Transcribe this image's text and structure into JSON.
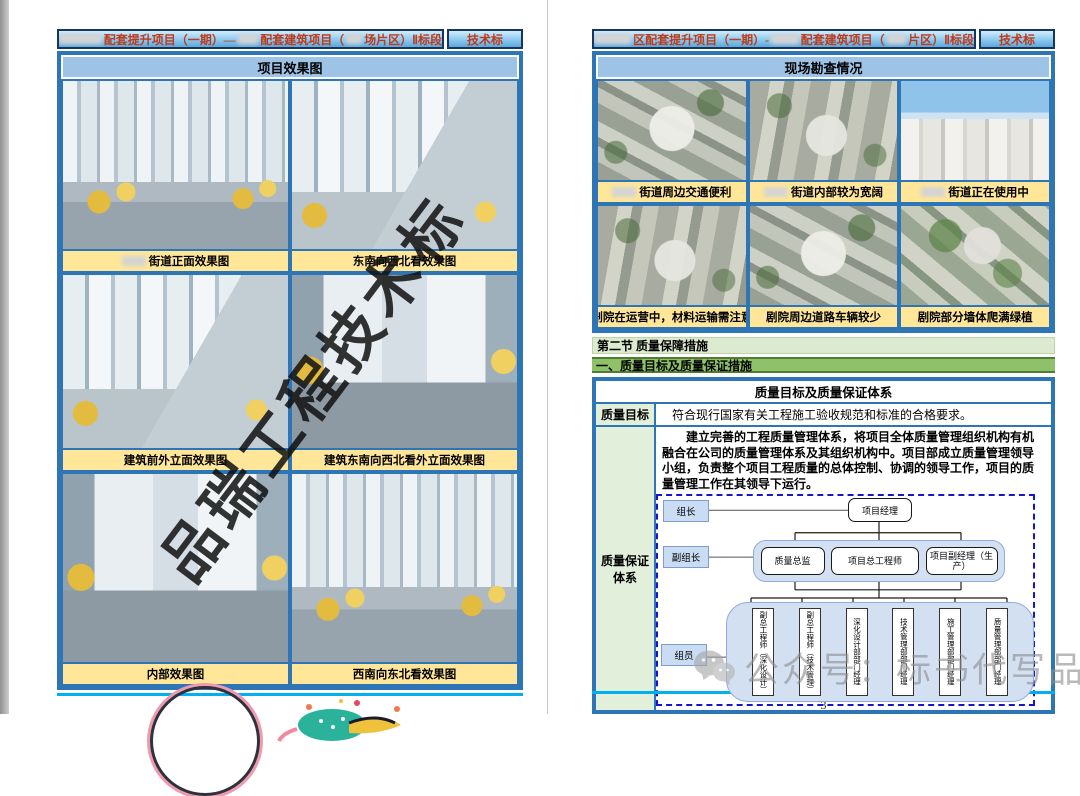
{
  "viewer": {
    "page_number": "3"
  },
  "header_left": {
    "segments": [
      {
        "r": 108
      },
      {
        "t": "配套提升项目（一期）—"
      },
      {
        "r": 52
      },
      {
        "t": "配套建筑项目（"
      },
      {
        "r": 40
      },
      {
        "t": "场片区）Ⅱ标段"
      }
    ],
    "tag": "技术标"
  },
  "header_right": {
    "segments": [
      {
        "r": 84
      },
      {
        "t": "区配套提升项目（一期）-"
      },
      {
        "r": 62
      },
      {
        "t": "配套建筑项目（"
      },
      {
        "r": 44
      },
      {
        "t": "片区）Ⅱ标段"
      }
    ],
    "tag": "技术标"
  },
  "left_page": {
    "section_title": "项目效果图",
    "diagonal_watermark": "品瑞工程技术标",
    "images": [
      {
        "caption": "街道正面效果图",
        "caption_redacted_prefix": true,
        "image_kind": "building-rendering"
      },
      {
        "caption": "东南向西北看效果图",
        "caption_redacted_prefix": false,
        "image_kind": "building-rendering"
      },
      {
        "caption": "建筑前外立面效果图",
        "caption_redacted_prefix": false,
        "image_kind": "building-rendering"
      },
      {
        "caption": "建筑东南向西北看外立面效果图",
        "caption_redacted_prefix": false,
        "image_kind": "building-rendering"
      },
      {
        "caption": "内部效果图",
        "caption_redacted_prefix": false,
        "image_kind": "building-rendering"
      },
      {
        "caption": "西南向东北看效果图",
        "caption_redacted_prefix": false,
        "image_kind": "building-rendering"
      }
    ]
  },
  "right_page": {
    "section_title": "现场勘查情况",
    "photos": [
      {
        "caption": "街道周边交通便利",
        "caption_redacted_prefix": true,
        "image_kind": "aerial-photo"
      },
      {
        "caption": "街道内部较为宽阔",
        "caption_redacted_prefix": true,
        "image_kind": "aerial-photo"
      },
      {
        "caption": "街道正在使用中",
        "caption_redacted_prefix": true,
        "image_kind": "street-photo"
      },
      {
        "caption": "剧院在运营中，材料运输需注意",
        "caption_redacted_prefix": false,
        "image_kind": "aerial-photo"
      },
      {
        "caption": "剧院周边道路车辆较少",
        "caption_redacted_prefix": false,
        "image_kind": "aerial-photo"
      },
      {
        "caption": "剧院部分墙体爬满绿植",
        "caption_redacted_prefix": false,
        "image_kind": "aerial-photo"
      }
    ],
    "section2_heading": "第二节 质量保障措施",
    "sub_heading": "一、质量目标及质量保证措施",
    "quality_table": {
      "title": "质量目标及质量保证体系",
      "row1_label": "质量目标",
      "row1_text": "符合现行国家有关工程施工验收规范和标准的合格要求。",
      "row2_label": "质量保证体系",
      "row2_text": "建立完善的工程质量管理体系，将项目全体质量管理组织机构有机融合在公司的质量管理体系及其组织机构中。项目部成立质量管理领导小组，负责整个项目工程质量的总体控制、协调的领导工作，项目的质量管理工作在其领导下运行。",
      "org_chart": {
        "role_labels": [
          "组长",
          "副组长",
          "组员"
        ],
        "top_node": "项目经理",
        "mid_nodes": [
          "质量总监",
          "项目总工程师",
          "项目副经理（生产）"
        ],
        "bottom_nodes": [
          "副总工程师（深化设计）",
          "副总工程师（技术管理）",
          "深化设计部部门经理",
          "技术管理部部门经理",
          "施工管理部部门经理",
          "质量管理部部门经理"
        ]
      }
    },
    "footer_watermark": "公众号：标书代写品瑞"
  },
  "colors": {
    "header_text": "#bf3a1a",
    "table_border": "#2e75b6",
    "caption_bg": "#ffe699",
    "section_title_bg": "#9dc3e6",
    "heading_light_green": "#dcead0",
    "heading_green": "#8fc06a",
    "label_cell_green": "#e2efda",
    "org_container_blue": "#d3e0f2",
    "org_role_blue": "#c9dcf3",
    "dashed_border_blue": "#1616c8",
    "footer_line_cyan": "#00b0f0",
    "watermark_grey": "#8f8f8f"
  }
}
